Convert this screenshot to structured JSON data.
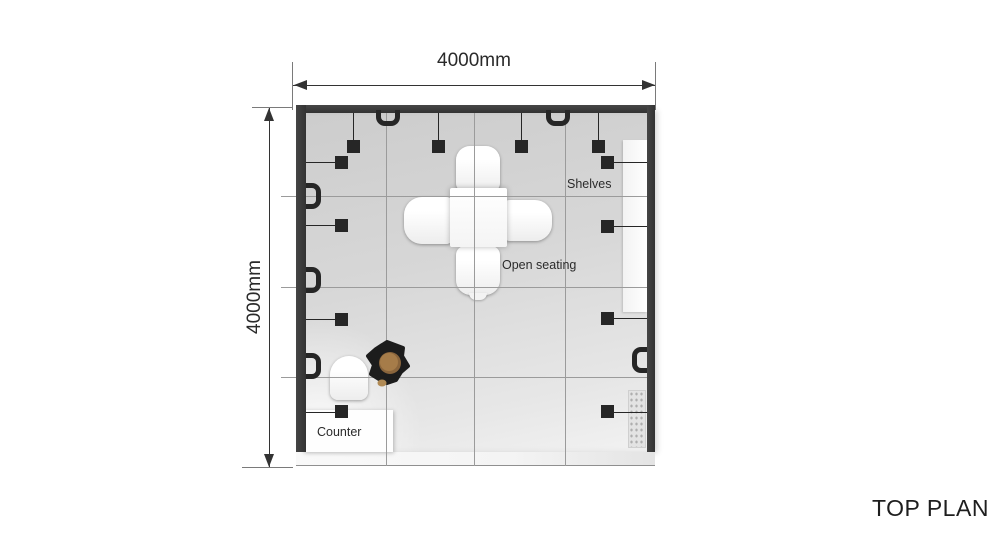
{
  "page": {
    "caption": "TOP PLAN",
    "background": "#ffffff"
  },
  "dimensions": {
    "top": {
      "label": "4000mm"
    },
    "left": {
      "label": "4000mm"
    }
  },
  "annotations": {
    "shelves": "Shelves",
    "open_seating": "Open seating",
    "counter": "Counter"
  },
  "colors": {
    "dim_line": "#333333",
    "grid_line": "#9b9b9b",
    "wall": "#3a3a3a",
    "fixture": "#262626",
    "text": "#2b2b2b",
    "person_body": "#1c1c1c",
    "person_head": "#a67c49"
  },
  "fixtures": {
    "pendant_squares_top_wall": 4,
    "bracket_squares_left_wall": 4,
    "bracket_squares_right_wall": 4,
    "rail_hooks_top_wall": 2,
    "rail_hooks_left_wall": 3,
    "rail_hooks_right_wall": 1,
    "shelf_panels_right_wall": 2
  }
}
